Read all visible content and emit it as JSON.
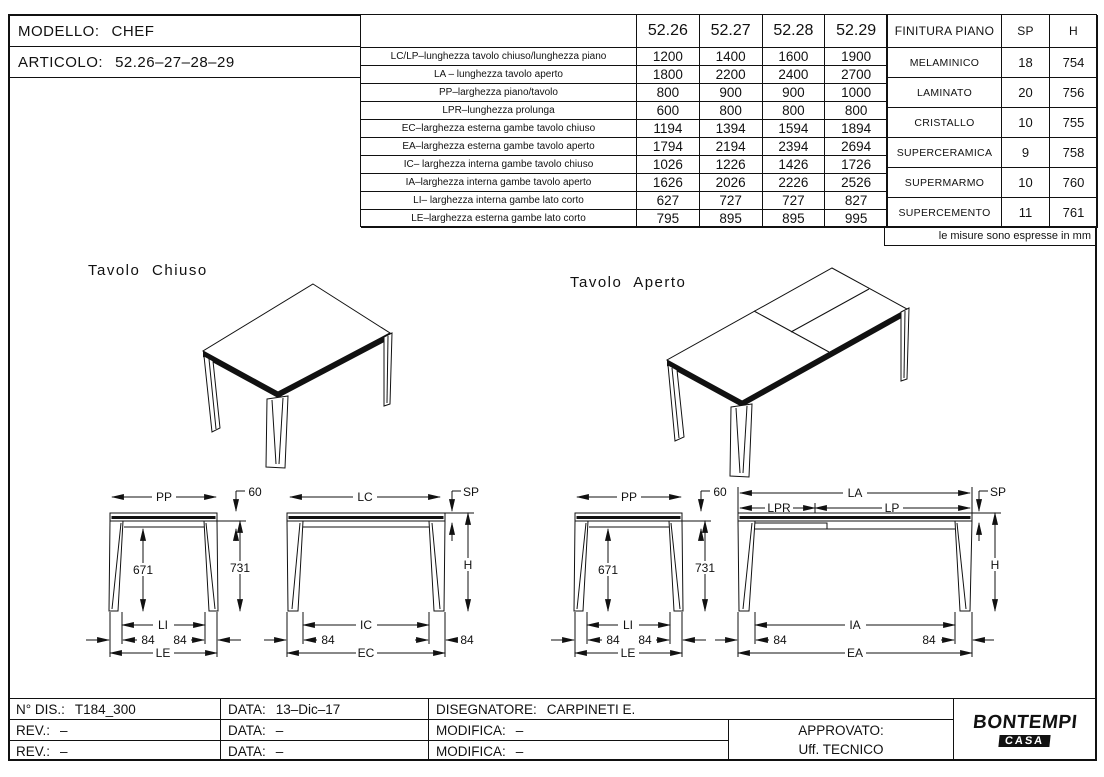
{
  "header": {
    "modello_label": "MODELLO:",
    "modello_value": "CHEF",
    "articolo_label": "ARTICOLO:",
    "articolo_value": "52.26–27–28–29"
  },
  "spec_table": {
    "col_headers": [
      "52.26",
      "52.27",
      "52.28",
      "52.29"
    ],
    "rows": [
      {
        "label": "LC/LP–lunghezza tavolo chiuso/lunghezza piano",
        "values": [
          "1200",
          "1400",
          "1600",
          "1900"
        ]
      },
      {
        "label": "LA – lunghezza tavolo aperto",
        "values": [
          "1800",
          "2200",
          "2400",
          "2700"
        ]
      },
      {
        "label": "PP–larghezza piano/tavolo",
        "values": [
          "800",
          "900",
          "900",
          "1000"
        ]
      },
      {
        "label": "LPR–lunghezza prolunga",
        "values": [
          "600",
          "800",
          "800",
          "800"
        ]
      },
      {
        "label": "EC–larghezza esterna gambe tavolo chiuso",
        "values": [
          "1194",
          "1394",
          "1594",
          "1894"
        ]
      },
      {
        "label": "EA–larghezza esterna gambe tavolo aperto",
        "values": [
          "1794",
          "2194",
          "2394",
          "2694"
        ]
      },
      {
        "label": "IC– larghezza interna gambe tavolo chiuso",
        "values": [
          "1026",
          "1226",
          "1426",
          "1726"
        ]
      },
      {
        "label": "IA–larghezza interna gambe tavolo aperto",
        "values": [
          "1626",
          "2026",
          "2226",
          "2526"
        ]
      },
      {
        "label": "LI– larghezza interna gambe lato corto",
        "values": [
          "627",
          "727",
          "727",
          "827"
        ]
      },
      {
        "label": "LE–larghezza esterna gambe lato corto",
        "values": [
          "795",
          "895",
          "895",
          "995"
        ]
      }
    ]
  },
  "finish_table": {
    "headers": [
      "FINITURA PIANO",
      "SP",
      "H"
    ],
    "rows": [
      {
        "finish": "MELAMINICO",
        "sp": "18",
        "h": "754"
      },
      {
        "finish": "LAMINATO",
        "sp": "20",
        "h": "756"
      },
      {
        "finish": "CRISTALLO",
        "sp": "10",
        "h": "755"
      },
      {
        "finish": "SUPERCERAMICA",
        "sp": "9",
        "h": "758"
      },
      {
        "finish": "SUPERMARMO",
        "sp": "10",
        "h": "760"
      },
      {
        "finish": "SUPERCEMENTO",
        "sp": "11",
        "h": "761"
      }
    ],
    "note": "le misure sono espresse in mm"
  },
  "drawings": {
    "closed_title": "Tavolo Chiuso",
    "open_title": "Tavolo Aperto",
    "dims": {
      "pp": "PP",
      "top60": "60",
      "h671": "671",
      "h731": "731",
      "li": "LI",
      "d84": "84",
      "le": "LE",
      "lc": "LC",
      "sp": "SP",
      "h": "H",
      "ic": "IC",
      "ec": "EC",
      "la": "LA",
      "lpr": "LPR",
      "lp": "LP",
      "ia": "IA",
      "ea": "EA"
    }
  },
  "title_block": {
    "rows": [
      [
        {
          "label": "N° DIS.:",
          "value": "T184_300"
        },
        {
          "label": "DATA:",
          "value": "13–Dic–17"
        },
        {
          "label": "DISEGNATORE:",
          "value": "CARPINETI E."
        }
      ],
      [
        {
          "label": "REV.:",
          "value": "–"
        },
        {
          "label": "DATA:",
          "value": "–"
        },
        {
          "label": "MODIFICA:",
          "value": "–"
        }
      ],
      [
        {
          "label": "REV.:",
          "value": "–"
        },
        {
          "label": "DATA:",
          "value": "–"
        },
        {
          "label": "MODIFICA:",
          "value": "–"
        }
      ]
    ],
    "approvato_line1": "APPROVATO:",
    "approvato_line2": "Uff.  TECNICO",
    "logo_line1": "BONTEMPI",
    "logo_line2": "CASA"
  }
}
